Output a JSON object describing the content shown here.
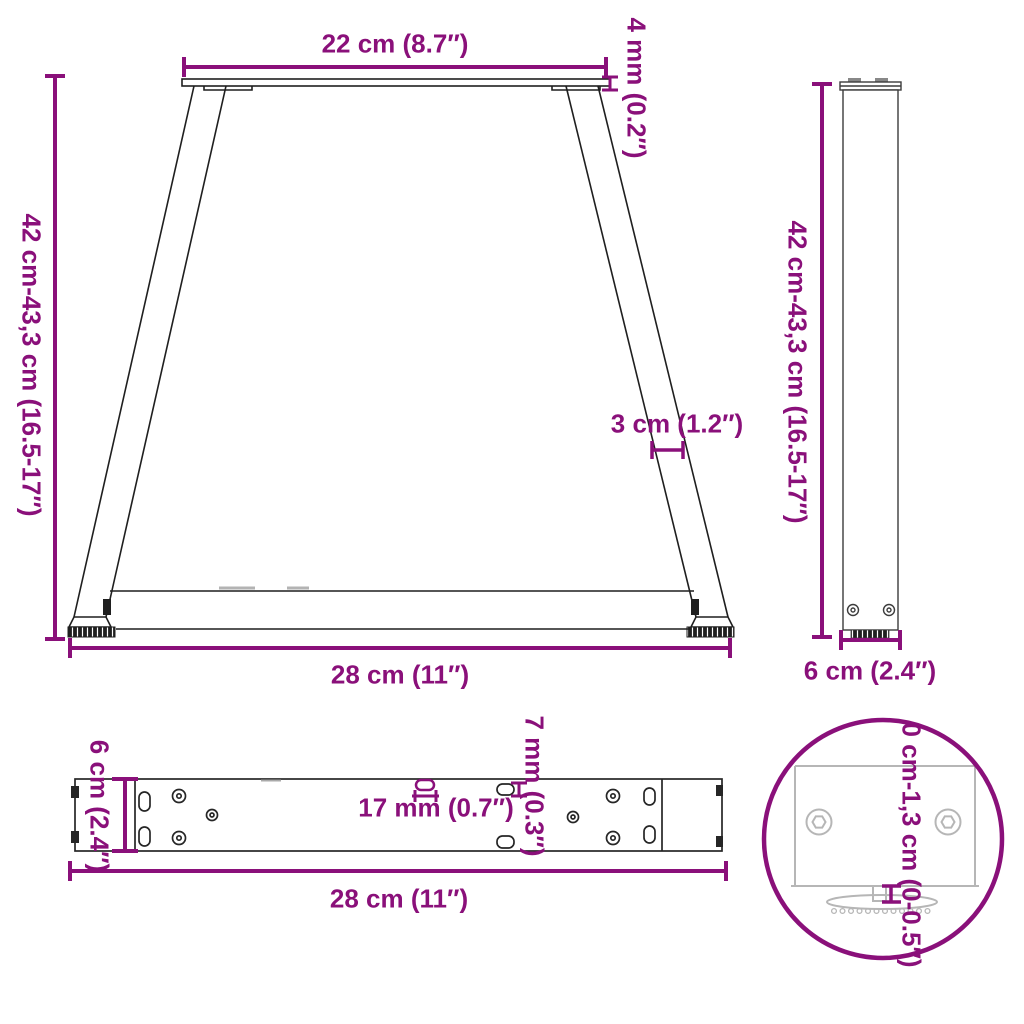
{
  "colors": {
    "dimension": "#8A107A",
    "drawing": "#1f1f1f",
    "side_drawing": "#3c3c3c",
    "plate_drawing": "#262626",
    "detail_drawing": "#b6b6b6",
    "background": "#ffffff"
  },
  "diagram": {
    "front_view": {
      "top_width": "22 cm (8.7″)",
      "plate_thickness": "4 mm (0.2″)",
      "height_range": "42 cm-43,3 cm (16.5-17″)",
      "leg_profile_width": "3 cm (1.2″)",
      "bottom_width": "28 cm (11″)"
    },
    "side_view": {
      "height_range": "42 cm-43,3 cm (16.5-17″)",
      "depth": "6 cm (2.4″)"
    },
    "plate_view": {
      "depth": "6 cm (2.4″)",
      "slot_length": "17 mm (0.7″)",
      "slot_width": "7 mm (0.3″)",
      "width": "28 cm (11″)"
    },
    "foot_detail": {
      "adjustment_range": "0 cm-1,3 cm (0-0.5″)"
    }
  }
}
